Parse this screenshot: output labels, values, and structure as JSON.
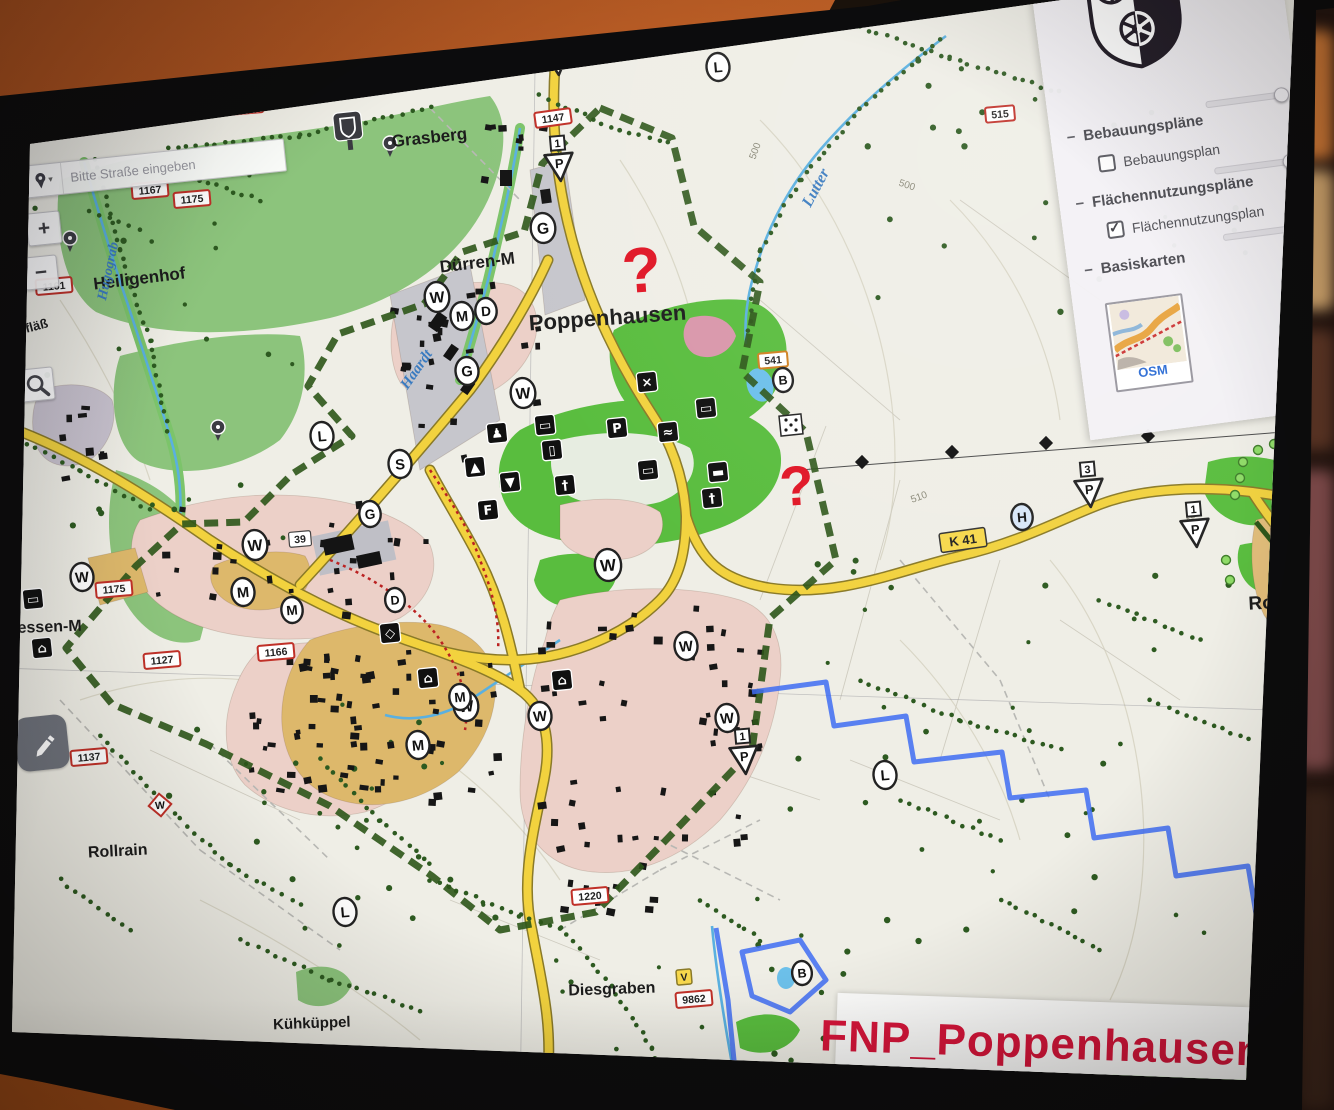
{
  "search": {
    "placeholder": "Bitte Straße eingeben",
    "dropdown_glyph": "▾"
  },
  "zoom_controls": {
    "zoom_in": "+",
    "zoom_out": "−"
  },
  "layer_panel": {
    "collapse_glyph": "−",
    "groups": [
      {
        "label": "Bebauungspläne"
      },
      {
        "label": "Flächennutzungspläne"
      },
      {
        "label": "Basiskarten"
      }
    ],
    "checkboxes": [
      {
        "label": "Bebauungsplan",
        "checked": false
      },
      {
        "label": "Flächennutzungsplan",
        "checked": true
      }
    ],
    "basemap_label": "OSM"
  },
  "plan_title": {
    "text": "FNP_Poppenhausen",
    "color": "#d6153a"
  },
  "colors": {
    "accent_red": "#d6153a",
    "road_yellow": "#f2d23e",
    "boundary_green": "#2c5518",
    "boundary_blue": "#3e6cf2",
    "residential_pink": "#ecd0c8",
    "mixed_use_tan": "#ddb86b",
    "green_space": "#59bd3e",
    "forest_green": "#8cc47c",
    "question_mark_red": "#e01525"
  },
  "map": {
    "place_labels": [
      {
        "t": "Poppenhausen",
        "x": 608,
        "y": 325,
        "s": 22,
        "r": -4,
        "b": 1
      },
      {
        "t": "Grasberg",
        "x": 430,
        "y": 143,
        "s": 17,
        "r": -6,
        "b": 1
      },
      {
        "t": "Heiligenhof",
        "x": 140,
        "y": 284,
        "s": 17,
        "r": -7,
        "b": 1
      },
      {
        "t": "Dürren-M",
        "x": 478,
        "y": 268,
        "s": 17,
        "r": -7,
        "b": 1
      },
      {
        "t": "Hessen-M",
        "x": 44,
        "y": 632,
        "s": 16,
        "r": -2,
        "b": 1
      },
      {
        "t": "Rollrain",
        "x": 118,
        "y": 856,
        "s": 16,
        "r": -3,
        "b": 1
      },
      {
        "t": "Kühküppel",
        "x": 312,
        "y": 1028,
        "s": 15,
        "r": -2,
        "b": 1
      },
      {
        "t": "Diesgraben",
        "x": 612,
        "y": 994,
        "s": 16,
        "r": -2,
        "b": 1
      },
      {
        "t": "Rodhof",
        "x": 1282,
        "y": 608,
        "s": 19,
        "r": -3,
        "b": 1
      },
      {
        "t": "ogfläß",
        "x": 30,
        "y": 332,
        "s": 13,
        "r": -15,
        "b": 1
      }
    ],
    "water_labels": [
      {
        "t": "Lutter",
        "x": 820,
        "y": 190,
        "s": 16,
        "r": -62
      },
      {
        "t": "Haardt",
        "x": 420,
        "y": 372,
        "s": 15,
        "r": -55
      },
      {
        "t": "Hugograb",
        "x": 112,
        "y": 272,
        "s": 14,
        "r": -78
      }
    ],
    "contour_labels": [
      {
        "t": "500",
        "x": 906,
        "y": 188,
        "r": 18
      },
      {
        "t": "510",
        "x": 920,
        "y": 500,
        "r": -20
      },
      {
        "t": "518",
        "x": 186,
        "y": 106,
        "r": -5
      },
      {
        "t": "500",
        "x": 758,
        "y": 152,
        "r": -70
      },
      {
        "t": "540",
        "x": 1192,
        "y": 522,
        "r": -60
      }
    ],
    "number_plates": [
      {
        "t": "1171",
        "x": 245,
        "y": 106,
        "st": "red"
      },
      {
        "t": "1147",
        "x": 553,
        "y": 118,
        "st": "red",
        "r": -8
      },
      {
        "t": "1167",
        "x": 150,
        "y": 190,
        "st": "red"
      },
      {
        "t": "1175",
        "x": 192,
        "y": 199,
        "st": "red"
      },
      {
        "t": "1161",
        "x": 54,
        "y": 286,
        "st": "red"
      },
      {
        "t": "1175",
        "x": 114,
        "y": 589,
        "st": "red"
      },
      {
        "t": "1127",
        "x": 162,
        "y": 660,
        "st": "red"
      },
      {
        "t": "1166",
        "x": 276,
        "y": 652,
        "st": "red"
      },
      {
        "t": "1137",
        "x": 89,
        "y": 757,
        "st": "red"
      },
      {
        "t": "1220",
        "x": 590,
        "y": 896,
        "st": "red"
      },
      {
        "t": "515",
        "x": 1000,
        "y": 114,
        "st": "red"
      },
      {
        "t": "9862",
        "x": 694,
        "y": 999,
        "st": "red"
      },
      {
        "t": "541",
        "x": 773,
        "y": 360,
        "st": "orange"
      },
      {
        "t": "V",
        "x": 684,
        "y": 977,
        "st": "yellow"
      },
      {
        "t": "39",
        "x": 300,
        "y": 539,
        "st": "white"
      },
      {
        "t": "K 41",
        "x": 963,
        "y": 540,
        "st": "road",
        "r": -8
      }
    ],
    "circle_markers": [
      {
        "l": "W",
        "x": 437,
        "y": 297,
        "rad": 15
      },
      {
        "l": "M",
        "x": 462,
        "y": 316,
        "rad": 14
      },
      {
        "l": "D",
        "x": 486,
        "y": 311,
        "rad": 13
      },
      {
        "l": "G",
        "x": 543,
        "y": 228,
        "rad": 15
      },
      {
        "l": "G",
        "x": 467,
        "y": 371,
        "rad": 14
      },
      {
        "l": "S",
        "x": 400,
        "y": 464,
        "rad": 14
      },
      {
        "l": "G",
        "x": 370,
        "y": 514,
        "rad": 13
      },
      {
        "l": "W",
        "x": 523,
        "y": 393,
        "rad": 15
      },
      {
        "l": "W",
        "x": 82,
        "y": 577,
        "rad": 14
      },
      {
        "l": "W",
        "x": 255,
        "y": 545,
        "rad": 15
      },
      {
        "l": "M",
        "x": 243,
        "y": 592,
        "rad": 14
      },
      {
        "l": "M",
        "x": 292,
        "y": 610,
        "rad": 13
      },
      {
        "l": "D",
        "x": 395,
        "y": 600,
        "rad": 12
      },
      {
        "l": "M",
        "x": 418,
        "y": 745,
        "rad": 14
      },
      {
        "l": "W",
        "x": 466,
        "y": 706,
        "rad": 15
      },
      {
        "l": "W",
        "x": 540,
        "y": 716,
        "rad": 14
      },
      {
        "l": "W",
        "x": 608,
        "y": 565,
        "rad": 16
      },
      {
        "l": "W",
        "x": 686,
        "y": 646,
        "rad": 14
      },
      {
        "l": "W",
        "x": 727,
        "y": 718,
        "rad": 14
      },
      {
        "l": "M",
        "x": 460,
        "y": 697,
        "rad": 13
      },
      {
        "l": "L",
        "x": 718,
        "y": 67,
        "rad": 14
      },
      {
        "l": "L",
        "x": 322,
        "y": 436,
        "rad": 14
      },
      {
        "l": "L",
        "x": 345,
        "y": 912,
        "rad": 14
      },
      {
        "l": "L",
        "x": 885,
        "y": 775,
        "rad": 14
      },
      {
        "l": "H",
        "x": 1022,
        "y": 517,
        "rad": 13,
        "st": "blue"
      },
      {
        "l": "B",
        "x": 783,
        "y": 380,
        "rad": 12
      },
      {
        "l": "B",
        "x": 802,
        "y": 973,
        "rad": 12
      },
      {
        "l": "W",
        "x": 160,
        "y": 805,
        "rad": 10,
        "st": "diamond"
      }
    ],
    "icon_squares": [
      {
        "g": "♟",
        "n": "figure-icon",
        "x": 497,
        "y": 433
      },
      {
        "g": "▲",
        "n": "triangle-up-icon",
        "x": 475,
        "y": 467
      },
      {
        "g": "▼",
        "n": "triangle-down-icon",
        "x": 510,
        "y": 482
      },
      {
        "g": "F",
        "n": "letter-f-icon",
        "x": 488,
        "y": 510
      },
      {
        "g": "▭",
        "n": "pond-icon",
        "x": 545,
        "y": 425
      },
      {
        "g": "▯",
        "n": "monument-icon",
        "x": 552,
        "y": 450
      },
      {
        "g": "×",
        "n": "mine-icon",
        "x": 647,
        "y": 382
      },
      {
        "g": "P",
        "n": "parking-icon",
        "x": 617,
        "y": 428
      },
      {
        "g": "≈",
        "n": "waterworks-icon",
        "x": 668,
        "y": 432
      },
      {
        "g": "▭",
        "n": "pool-icon",
        "x": 706,
        "y": 408
      },
      {
        "g": "▭",
        "n": "bath-icon",
        "x": 648,
        "y": 470
      },
      {
        "g": "▬",
        "n": "bus-icon",
        "x": 718,
        "y": 472
      },
      {
        "g": "†",
        "n": "cemetery-icon",
        "x": 565,
        "y": 485
      },
      {
        "g": "†",
        "n": "cemetery-icon",
        "x": 712,
        "y": 498
      },
      {
        "g": "⌂",
        "n": "homestead-icon",
        "x": 428,
        "y": 678
      },
      {
        "g": "⌂",
        "n": "homestead-icon",
        "x": 562,
        "y": 680
      },
      {
        "g": "◇",
        "n": "diamond-icon",
        "x": 390,
        "y": 633
      },
      {
        "g": "▭",
        "n": "pond-icon",
        "x": 33,
        "y": 599
      },
      {
        "g": "⌂",
        "n": "chapel-icon",
        "x": 42,
        "y": 648
      }
    ],
    "triangle_markers": [
      {
        "num": "",
        "x": 558,
        "y": 66
      },
      {
        "num": "1",
        "x": 560,
        "y": 172
      },
      {
        "num": "3",
        "x": 1090,
        "y": 498
      },
      {
        "num": "1",
        "x": 1196,
        "y": 538
      },
      {
        "num": "1",
        "x": 745,
        "y": 765
      }
    ],
    "question_marks": [
      {
        "x": 643,
        "y": 292,
        "s": 64
      },
      {
        "x": 798,
        "y": 505,
        "s": 56
      }
    ]
  }
}
